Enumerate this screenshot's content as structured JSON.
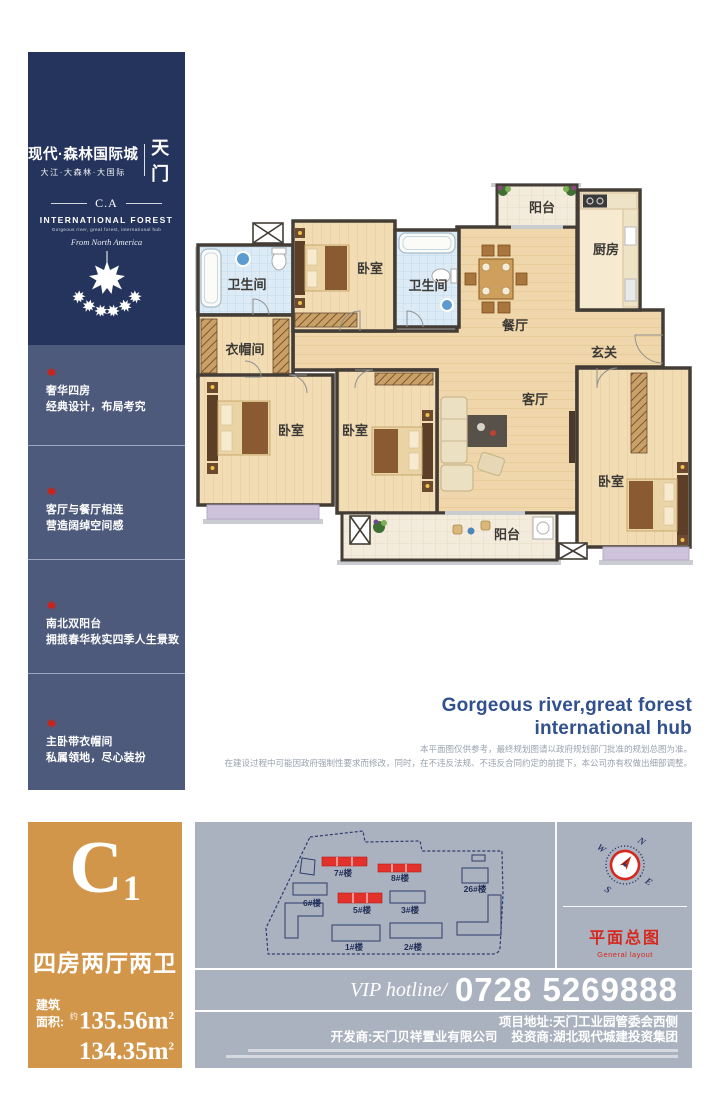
{
  "brand": {
    "title": "现代·森林国际城",
    "subtitle": "大江·大森林·大国际",
    "city": "天门",
    "monogram": "C.A",
    "en_name": "INTERNATIONAL FOREST",
    "en_tagline": "Gorgeous river, great forest, international hub",
    "origin_script": "From North America"
  },
  "selling_points": [
    {
      "line1": "奢华四房",
      "line2": "经典设计，布局考究"
    },
    {
      "line1": "客厅与餐厅相连",
      "line2": "营造阔绰空间感"
    },
    {
      "line1": "南北双阳台",
      "line2": "拥揽春华秋实四季人生景致"
    },
    {
      "line1": "主卧带衣帽间",
      "line2": "私属领地，尽心装扮"
    }
  ],
  "floorplan": {
    "rooms": {
      "bath1": "卫生间",
      "bedroom_top": "卧室",
      "bath2": "卫生间",
      "dining": "餐厅",
      "balcony_top": "阳台",
      "kitchen": "厨房",
      "foyer": "玄关",
      "cloak": "衣帽间",
      "bedroom_left": "卧室",
      "bedroom_mid": "卧室",
      "living": "客厅",
      "bedroom_right": "卧室",
      "balcony_bottom": "阳台"
    }
  },
  "tagline": {
    "line1": "Gorgeous river,great forest",
    "line2": "international hub"
  },
  "disclaimer": {
    "line1": "本平面图仅供参考，最终规划图请以政府规划部门批准的规划总图为准。",
    "line2": "在建设过程中可能因政府强制性要求而修改，同时，在不违反法规、不违反合同约定的前提下，本公司亦有权做出细部调整。"
  },
  "unit": {
    "code": "C",
    "code_sub": "1",
    "layout": "四房两厅两卫",
    "area_label": "建筑面积:",
    "area_prefix": "约",
    "areas": [
      {
        "value": "135.56m",
        "sup": "2"
      },
      {
        "value": "134.35m",
        "sup": "2"
      }
    ]
  },
  "siteplan": {
    "buildings": [
      {
        "label": "7#楼",
        "highlight": true
      },
      {
        "label": "8#楼",
        "highlight": true
      },
      {
        "label": "26#楼",
        "highlight": false
      },
      {
        "label": "6#楼",
        "highlight": false
      },
      {
        "label": "5#楼",
        "highlight": true
      },
      {
        "label": "3#楼",
        "highlight": false
      },
      {
        "label": "1#楼",
        "highlight": false
      },
      {
        "label": "2#楼",
        "highlight": false
      }
    ],
    "compass": {
      "n": "N",
      "e": "E",
      "s": "S",
      "w": "W"
    },
    "legend_title": "平面总图",
    "legend_sub": "General layout"
  },
  "hotline": {
    "prefix": "VIP hotline/",
    "number": "0728 5269888"
  },
  "contact": {
    "address": "项目地址:天门工业园管委会西侧",
    "developer": "开发商:天门贝祥置业有限公司",
    "investor": "投资商:湖北现代城建投资集团"
  },
  "colors": {
    "navy": "#25345c",
    "slate": "#4d5a7c",
    "orange": "#d2964a",
    "panel_gray": "#abb2bf",
    "accent_red": "#d6281f",
    "tagline_blue": "#31508e"
  }
}
